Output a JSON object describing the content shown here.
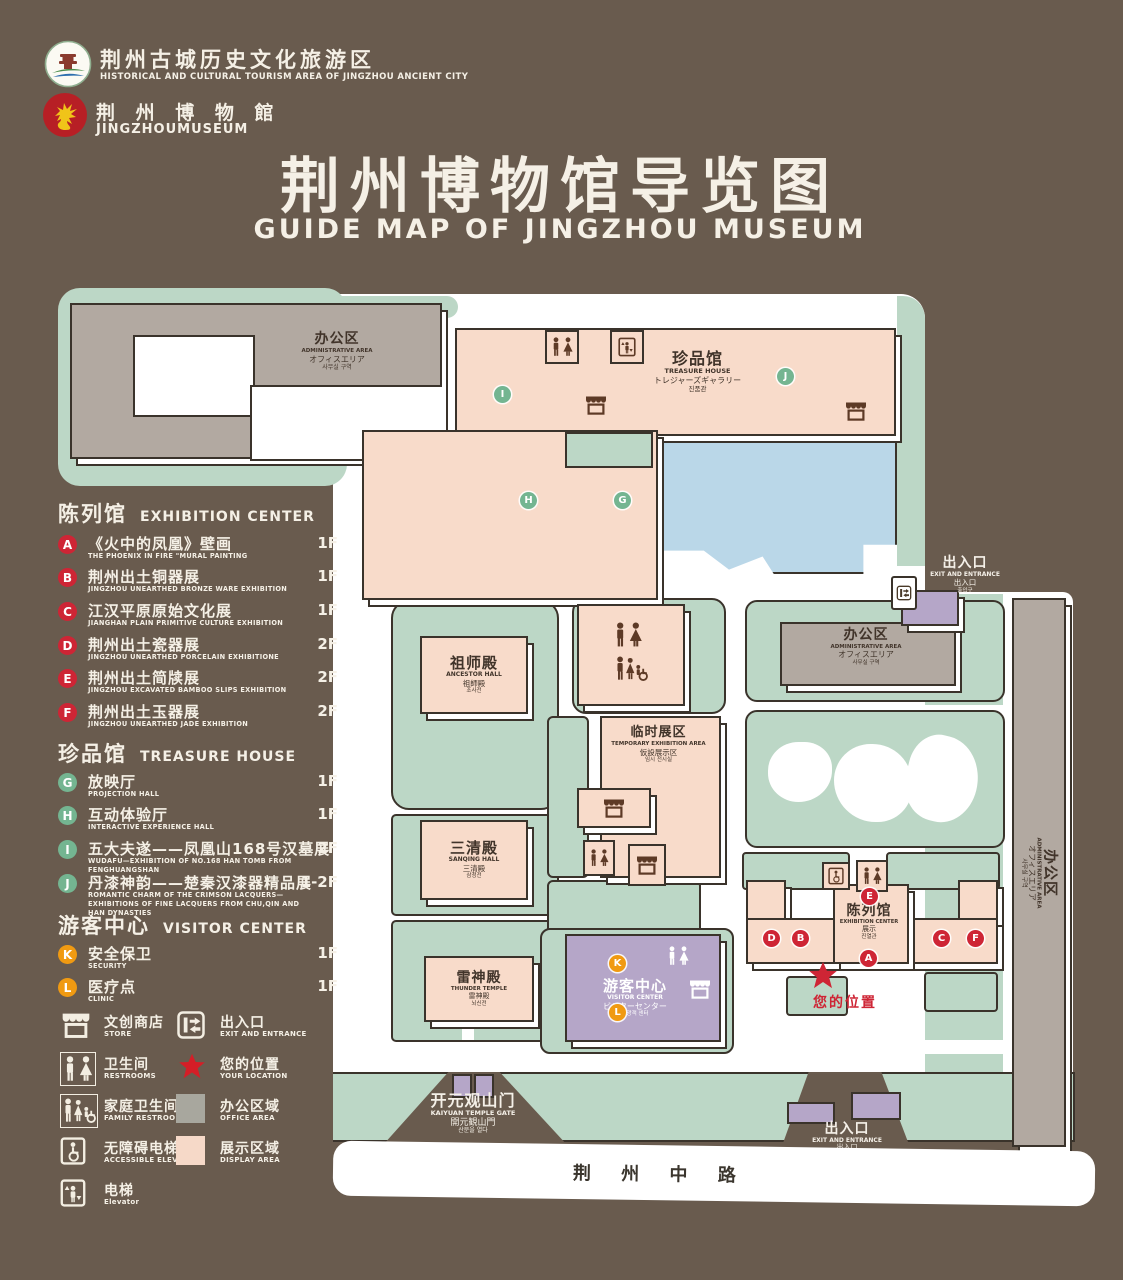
{
  "header": {
    "logo1": {
      "title": "荆州古城历史文化旅游区",
      "subtitle": "HISTORICAL AND CULTURAL TOURISM AREA OF JINGZHOU ANCIENT CITY"
    },
    "logo2": {
      "title": "荆 州 博 物 館",
      "subtitle": "JINGZHOUMUSEUM"
    },
    "title": "荆州博物馆导览图",
    "subtitle": "GUIDE MAP OF JINGZHOU MUSEUM"
  },
  "legend": {
    "sections": [
      {
        "zh": "陈列馆",
        "en": "EXHIBITION CENTER",
        "items": [
          {
            "letter": "A",
            "zh": "《火中的凤凰》壁画",
            "en": "THE PHOENIX IN FIRE \"MURAL PAINTING",
            "floor": "1F"
          },
          {
            "letter": "B",
            "zh": "荆州出土铜器展",
            "en": "JINGZHOU UNEARTHED BRONZE WARE EXHIBITION",
            "floor": "1F"
          },
          {
            "letter": "C",
            "zh": "江汉平原原始文化展",
            "en": "JIANGHAN PLAIN PRIMITIVE CULTURE EXHIBITION",
            "floor": "1F"
          },
          {
            "letter": "D",
            "zh": "荆州出土瓷器展",
            "en": "JINGZHOU UNEARTHED PORCELAIN EXHIBITIONE",
            "floor": "2F"
          },
          {
            "letter": "E",
            "zh": "荆州出土简牍展",
            "en": "JINGZHOU EXCAVATED BAMBOO SLIPS EXHIBITION",
            "floor": "2F"
          },
          {
            "letter": "F",
            "zh": "荆州出土玉器展",
            "en": "JINGZHOU UNEARTHED JADE EXHIBITION",
            "floor": "2F"
          }
        ]
      },
      {
        "zh": "珍品馆",
        "en": "TREASURE HOUSE",
        "items": [
          {
            "letter": "G",
            "zh": "放映厅",
            "en": "PROJECTION HALL",
            "floor": "1F"
          },
          {
            "letter": "H",
            "zh": "互动体验厅",
            "en": "INTERACTIVE EXPERIENCE HALL",
            "floor": "1F"
          },
          {
            "letter": "I",
            "zh": "五大夫遂——凤凰山168号汉墓展",
            "en": "WUDAFU—EXHIBITION OF NO.168 HAN TOMB FROM FENGHUANGSHAN",
            "floor": "2F"
          },
          {
            "letter": "J",
            "zh": "丹漆神韵——楚秦汉漆器精品展",
            "en": "ROMANTIC CHARM OF THE CRIMSON LACQUERS—EXHIBITIONS OF FINE LACQUERS FROM CHU,QIN AND HAN DYNASTIES",
            "floor": "1-2F"
          }
        ]
      },
      {
        "zh": "游客中心",
        "en": "VISITOR CENTER",
        "items": [
          {
            "letter": "K",
            "zh": "安全保卫",
            "en": "SECURITY",
            "floor": "1F"
          },
          {
            "letter": "L",
            "zh": "医疗点",
            "en": "CLINIC",
            "floor": "1F"
          }
        ]
      }
    ],
    "symbols": [
      {
        "icon": "store-icon",
        "zh": "文创商店",
        "en": "STORE"
      },
      {
        "icon": "exit-entrance-icon",
        "zh": "出入口",
        "en": "EXIT AND ENTRANCE"
      },
      {
        "icon": "restrooms-icon",
        "zh": "卫生间",
        "en": "RESTROOMS"
      },
      {
        "icon": "location-star-icon",
        "zh": "您的位置",
        "en": "YOUR LOCATION"
      },
      {
        "icon": "family-restroom-icon",
        "zh": "家庭卫生间",
        "en": "FAMILY RESTROOMS"
      },
      {
        "icon": "office-area-swatch",
        "zh": "办公区域",
        "en": "OFFICE AREA"
      },
      {
        "icon": "accessible-elevator-icon",
        "zh": "无障碍电梯",
        "en": "ACCESSIBLE ELEVATOR"
      },
      {
        "icon": "display-area-swatch",
        "zh": "展示区域",
        "en": "DISPLAY AREA"
      },
      {
        "icon": "elevator-icon",
        "zh": "电梯",
        "en": "Elevator"
      }
    ]
  },
  "map": {
    "labels": {
      "admin": {
        "zh": "办公区",
        "en": "ADMINISTRATIVE AREA",
        "jp": "オフィスエリア",
        "kr": "사무실 구역"
      },
      "treasure": {
        "zh": "珍品馆",
        "en": "TREASURE HOUSE",
        "jp": "トレジャーズギャラリー",
        "kr": "진품관"
      },
      "ancestor": {
        "zh": "祖师殿",
        "en": "ANCESTOR HALL",
        "jp": "祖師殿",
        "kr": "조사전"
      },
      "sanqing": {
        "zh": "三清殿",
        "en": "SANQING HALL",
        "jp": "三清殿",
        "kr": "삼청전"
      },
      "thunder": {
        "zh": "雷神殿",
        "en": "THUNDER TEMPLE",
        "jp": "雷神殿",
        "kr": "뇌신전"
      },
      "temporary": {
        "zh": "临时展区",
        "en": "TEMPORARY EXHIBITION AREA",
        "jp": "仮設展示区",
        "kr": "임시 전시실"
      },
      "exhibition": {
        "zh": "陈列馆",
        "en": "EXHIBITION CENTER",
        "jp": "展示",
        "kr": "진열관"
      },
      "visitor": {
        "zh": "游客中心",
        "en": "VISITOR CENTER",
        "jp": "ビジターセンター",
        "kr": "관광객 센터"
      },
      "exit": {
        "zh": "出入口",
        "en": "EXIT AND ENTRANCE",
        "jp": "出入口",
        "kr": "출입구"
      },
      "gate": {
        "zh": "开元观山门",
        "en": "KAIYUAN TEMPLE GATE",
        "jp": "開元観山門",
        "kr": "산문을 열다"
      },
      "road": "荆 州 中 路",
      "your_location": "您的位置"
    },
    "markers": [
      {
        "letter": "A"
      },
      {
        "letter": "B"
      },
      {
        "letter": "C"
      },
      {
        "letter": "D"
      },
      {
        "letter": "E"
      },
      {
        "letter": "F"
      },
      {
        "letter": "G"
      },
      {
        "letter": "H"
      },
      {
        "letter": "I"
      },
      {
        "letter": "J"
      },
      {
        "letter": "K"
      },
      {
        "letter": "L"
      }
    ],
    "colors": {
      "background": "#695b4e",
      "display_area": "#f8dbca",
      "office_area": "#b2a9a1",
      "green_area": "#bcd7c6",
      "pond": "#bad7e8",
      "visitor_purple": "#b5a6c8",
      "marker_red": "#ce2535",
      "marker_green": "#74b591",
      "marker_orange": "#f09a12"
    }
  }
}
